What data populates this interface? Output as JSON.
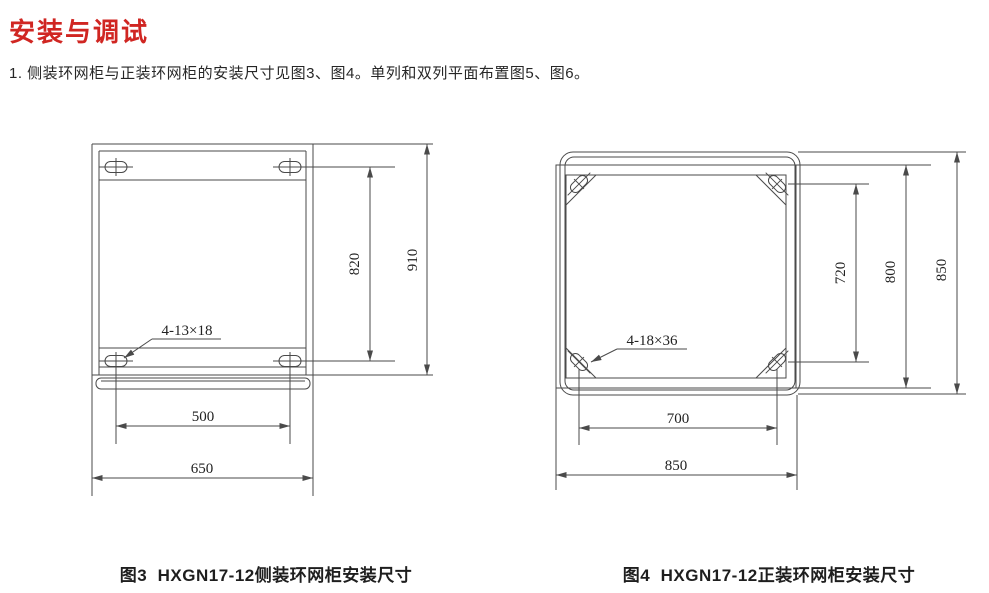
{
  "page": {
    "title": "安装与调试",
    "intro": "1. 侧装环网柜与正装环网柜的安装尺寸见图3、图4。单列和双列平面布置图5、图6。"
  },
  "colors": {
    "heading_red": "#d02622",
    "drawing_line": "#4a4a4a"
  },
  "figures": [
    {
      "id": "figure3",
      "caption": "图3  HXGN17-12侧装环网柜安装尺寸",
      "slot_label": "4-13×18",
      "dimensions": {
        "slot_spacing_vertical": "820",
        "overall_height": "910",
        "slot_spacing_horizontal": "500",
        "overall_width": "650"
      }
    },
    {
      "id": "figure4",
      "caption": "图4  HXGN17-12正装环网柜安装尺寸",
      "slot_label": "4-18×36",
      "dimensions": {
        "slot_spacing_vertical": "720",
        "frame_height": "800",
        "overall_height": "850",
        "slot_spacing_horizontal": "700",
        "overall_width": "850"
      }
    }
  ]
}
